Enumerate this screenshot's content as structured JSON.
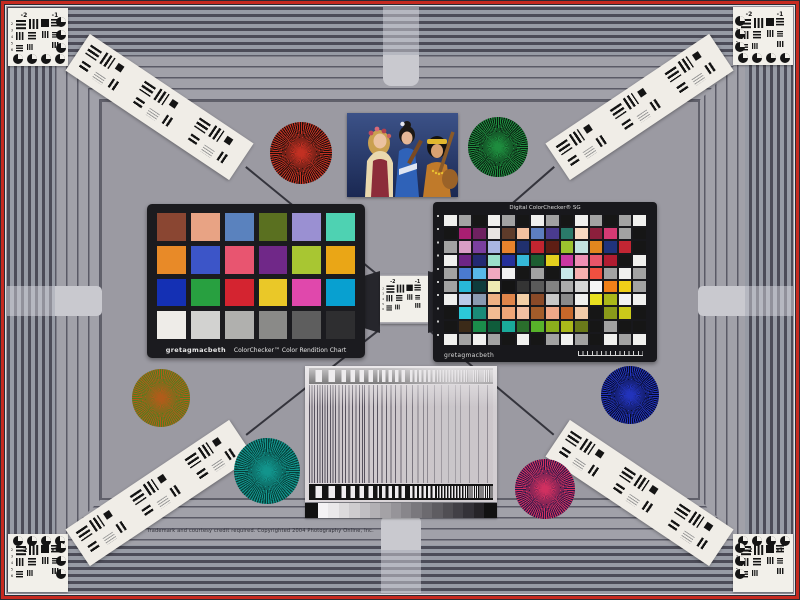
{
  "scene": {
    "credit_line": "Trademark and courtesy credit required. Copyrighted 2004 Photography Online, Inc."
  },
  "colors": {
    "field": "#9b9aa2",
    "stripe_dark": "#4c4c58",
    "stripe_light": "#979ba5",
    "border_red": "#c62a20",
    "card_white": "#f2f0ea",
    "chart_frame": "#1b1b1f"
  },
  "usaf": {
    "group_labels": [
      "-2",
      "-1"
    ],
    "element_numbers": [
      "2",
      "3",
      "4",
      "5",
      "6"
    ]
  },
  "colorchecker_classic": {
    "brand": "gretagmacbeth",
    "title": "ColorChecker™ Color Rendition Chart",
    "rows": 4,
    "cols": 6,
    "patch_names": [
      "dark skin",
      "light skin",
      "blue sky",
      "foliage",
      "blue flower",
      "bluish green",
      "orange",
      "purplish blue",
      "moderate red",
      "purple",
      "yellow green",
      "orange yellow",
      "blue",
      "green",
      "red",
      "yellow",
      "magenta",
      "cyan",
      "white",
      "neutral 8",
      "neutral 6.5",
      "neutral 5",
      "neutral 3.5",
      "black"
    ],
    "patches": [
      "#8a4632",
      "#e8a384",
      "#5a82be",
      "#5a7020",
      "#9a90d2",
      "#4ed2b2",
      "#e88a28",
      "#3c55c8",
      "#e85570",
      "#702888",
      "#a8c632",
      "#eaa616",
      "#1430b4",
      "#28a040",
      "#d42430",
      "#eac828",
      "#e048ac",
      "#08a0d0",
      "#eeece8",
      "#d2d2d0",
      "#b0b0ae",
      "#8a8a88",
      "#5e5e5e",
      "#2e2e30"
    ]
  },
  "colorchecker_sg": {
    "brand": "gretagmacbeth",
    "title": "Digital ColorChecker® SG",
    "rows": 10,
    "cols": 14,
    "patches": [
      "#f0f0ee",
      "#a2a2a2",
      "#161616",
      "#f0f0ee",
      "#a2a2a2",
      "#161616",
      "#f0f0ee",
      "#a2a2a2",
      "#161616",
      "#f0f0ee",
      "#a2a2a2",
      "#161616",
      "#a2a2a2",
      "#f0f0ee",
      "#161616",
      "#a81f72",
      "#6e2160",
      "#e9e4e2",
      "#5e3b2a",
      "#f3c09f",
      "#5d7ec0",
      "#4a3b8e",
      "#2a7a6a",
      "#f6d9c2",
      "#8c1f3c",
      "#d63a74",
      "#a2a2a2",
      "#161616",
      "#a2a2a2",
      "#d99ec6",
      "#7a3f9e",
      "#aab6e2",
      "#e8832c",
      "#20306e",
      "#c22530",
      "#5e1e14",
      "#9cc22e",
      "#c2e2e0",
      "#e2861e",
      "#20337c",
      "#c22633",
      "#161616",
      "#f0f0ee",
      "#6e2585",
      "#232a72",
      "#9adfc9",
      "#25309b",
      "#35b8d8",
      "#1c5e31",
      "#e3cf1e",
      "#c937a2",
      "#ef8fb4",
      "#e85568",
      "#b01c31",
      "#161616",
      "#f0f0ee",
      "#a2a2a2",
      "#4a7ad0",
      "#58b8e8",
      "#f0a8c0",
      "#f0f0f0",
      "#161616",
      "#a2a2a2",
      "#161616",
      "#c8e8e8",
      "#f8b0b0",
      "#f05040",
      "#a2a2a2",
      "#f0f0ee",
      "#a2a2a2",
      "#a2a2a2",
      "#28b8d8",
      "#0e3c3c",
      "#eeeab2",
      "#141414",
      "#343434",
      "#5a5a5a",
      "#828282",
      "#ababab",
      "#d5d5d5",
      "#f5f5f5",
      "#f08018",
      "#f0d018",
      "#a2a2a2",
      "#f0f0ee",
      "#b9c9e9",
      "#8a9ab0",
      "#efb183",
      "#e0854a",
      "#f3cfa6",
      "#8a4a28",
      "#c8c8c8",
      "#8a8a8a",
      "#f0f0ee",
      "#e8e020",
      "#aab819",
      "#f2f2f2",
      "#f0f0ee",
      "#161616",
      "#2cc9d9",
      "#1a8a78",
      "#f2bb92",
      "#efa678",
      "#f2bfa2",
      "#a35c2a",
      "#f0a888",
      "#c8682a",
      "#f2cbaa",
      "#161616",
      "#8a9a1a",
      "#cbca1a",
      "#161616",
      "#161616",
      "#3b2a18",
      "#1b8c4b",
      "#0f5c3b",
      "#1aaa9a",
      "#2a6e2c",
      "#58b22a",
      "#8aae1c",
      "#abb81a",
      "#6a7a1a",
      "#161616",
      "#a2a2a2",
      "#161616",
      "#161616",
      "#f0f0ee",
      "#a2a2a2",
      "#f0f0ee",
      "#a2a2a2",
      "#161616",
      "#f0f0ee",
      "#161616",
      "#a2a2a2",
      "#f0f0ee",
      "#a2a2a2",
      "#161616",
      "#f0f0ee",
      "#a2a2a2",
      "#f0f0ee"
    ]
  },
  "step_wedge": {
    "end_black": "#111111",
    "steps": [
      "#f4f2f4",
      "#eae8ea",
      "#dcdadc",
      "#cecccf",
      "#c0bec2",
      "#b2b0b4",
      "#a4a2a6",
      "#969499",
      "#88868b",
      "#7a787d",
      "#6c6a6f",
      "#5e5c61",
      "#504e53",
      "#424046",
      "#343238",
      "#262428"
    ]
  },
  "siemens_stars": [
    {
      "name": "red-star",
      "spoke": "#c23022",
      "gap": "#1c100c"
    },
    {
      "name": "green-star",
      "spoke": "#1e8c3e",
      "gap": "#0a1c10"
    },
    {
      "name": "olive-star",
      "spoke": "#b05c1a",
      "gap": "#4f7d1e"
    },
    {
      "name": "teal-star",
      "spoke": "#12948c",
      "gap": "#073d38"
    },
    {
      "name": "blue-star",
      "spoke": "#2233bb",
      "gap": "#070b28"
    },
    {
      "name": "magenta-star",
      "spoke": "#d03060",
      "gap": "#2a1848"
    }
  ],
  "photo": {
    "description": "Three women in folk costumes with musical instruments against a dark blue background"
  }
}
